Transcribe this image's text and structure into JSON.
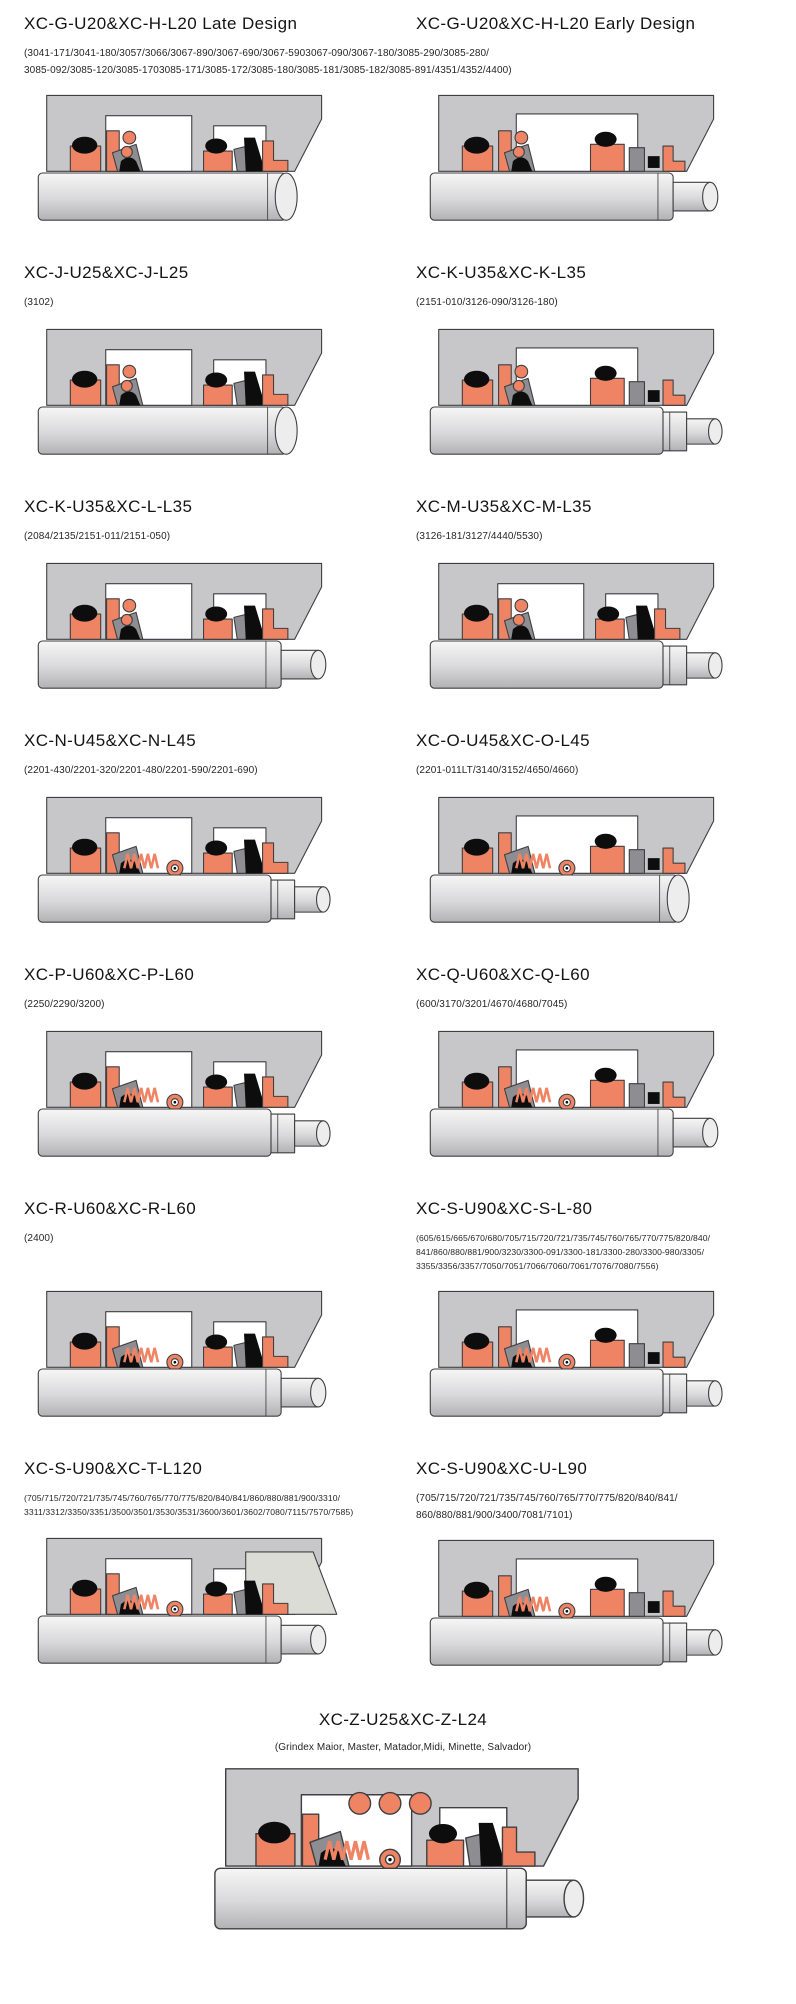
{
  "colors": {
    "seal_orange": "#ef8465",
    "housing_gray": "#c7c7c9",
    "wedge_gray": "#dcdcd6",
    "elastomer_black": "#0d0d0d",
    "hardware_gray": "#8e8e92",
    "outline": "#3f3f42",
    "shaft_highlight": "#f6f6f6",
    "shaft_mid": "#d9d9db",
    "shaft_shadow": "#b2b2b4",
    "shaft_end": "#ededed"
  },
  "entries": [
    {
      "title": "XC-G-U20&XC-H-L20 Late Design",
      "variant": "A",
      "lines": [
        "(3041-171/3041-180/3057/3066/3067-890/3067-690/3067-5903067-090/3067-180/3085-290/3085-280/",
        "3085-092/3085-120/3085-1703085-171/3085-172/3085-180/3085-181/3085-182/3085-891/4351/4352/4400)"
      ]
    },
    {
      "title": "XC-G-U20&XC-H-L20 Early Design",
      "variant": "B",
      "lines": []
    },
    {
      "title": "XC-J-U25&XC-J-L25",
      "variant": "J",
      "lines": [
        "(3102)"
      ]
    },
    {
      "title": "XC-K-U35&XC-K-L35",
      "variant": "K",
      "lines": [
        "(2151-010/3126-090/3126-180)"
      ]
    },
    {
      "title": "XC-K-U35&XC-L-L35",
      "variant": "KL",
      "lines": [
        "(2084/2135/2151-011/2151-050)"
      ]
    },
    {
      "title": "XC-M-U35&XC-M-L35",
      "variant": "M",
      "lines": [
        "(3126-181/3127/4440/5530)"
      ]
    },
    {
      "title": "XC-N-U45&XC-N-L45",
      "variant": "N",
      "lines": [
        "(2201-430/2201-320/2201-480/2201-590/2201-690)"
      ]
    },
    {
      "title": "XC-O-U45&XC-O-L45",
      "variant": "O",
      "lines": [
        "(2201-011LT/3140/3152/4650/4660)"
      ]
    },
    {
      "title": "XC-P-U60&XC-P-L60",
      "variant": "P",
      "lines": [
        "(2250/2290/3200)"
      ]
    },
    {
      "title": "XC-Q-U60&XC-Q-L60",
      "variant": "Q",
      "lines": [
        "(600/3170/3201/4670/4680/7045)"
      ]
    },
    {
      "title": "XC-R-U60&XC-R-L60",
      "variant": "R",
      "lines": [
        "(2400)"
      ]
    },
    {
      "title": "XC-S-U90&XC-S-L-80",
      "variant": "S",
      "lines": [
        "(605/615/665/670/680/705/715/720/721/735/745/760/765/770/775/820/840/",
        "841/860/880/881/900/3230/3300-091/3300-181/3300-280/3300-980/3305/",
        "3355/3356/3357/7050/7051/7066/7060/7061/7076/7080/7556)"
      ]
    },
    {
      "title": "XC-S-U90&XC-T-L120",
      "variant": "T",
      "lines": [
        "(705/715/720/721/735/745/760/765/770/775/820/840/841/860/880/881/900/3310/",
        "3311/3312/3350/3351/3500/3501/3530/3531/3600/3601/3602/7080/7115/7570/7585)"
      ]
    },
    {
      "title": "XC-S-U90&XC-U-L90",
      "variant": "U",
      "lines": [
        "(705/715/720/721/735/745/760/765/770/775/820/840/841/",
        "860/880/881/900/3400/7081/7101)"
      ]
    },
    {
      "title": "XC-Z-U25&XC-Z-L24",
      "variant": "Z",
      "lines": [
        "(Grindex  Maior, Master, Matador,Midi, Minette, Salvador)"
      ]
    }
  ]
}
